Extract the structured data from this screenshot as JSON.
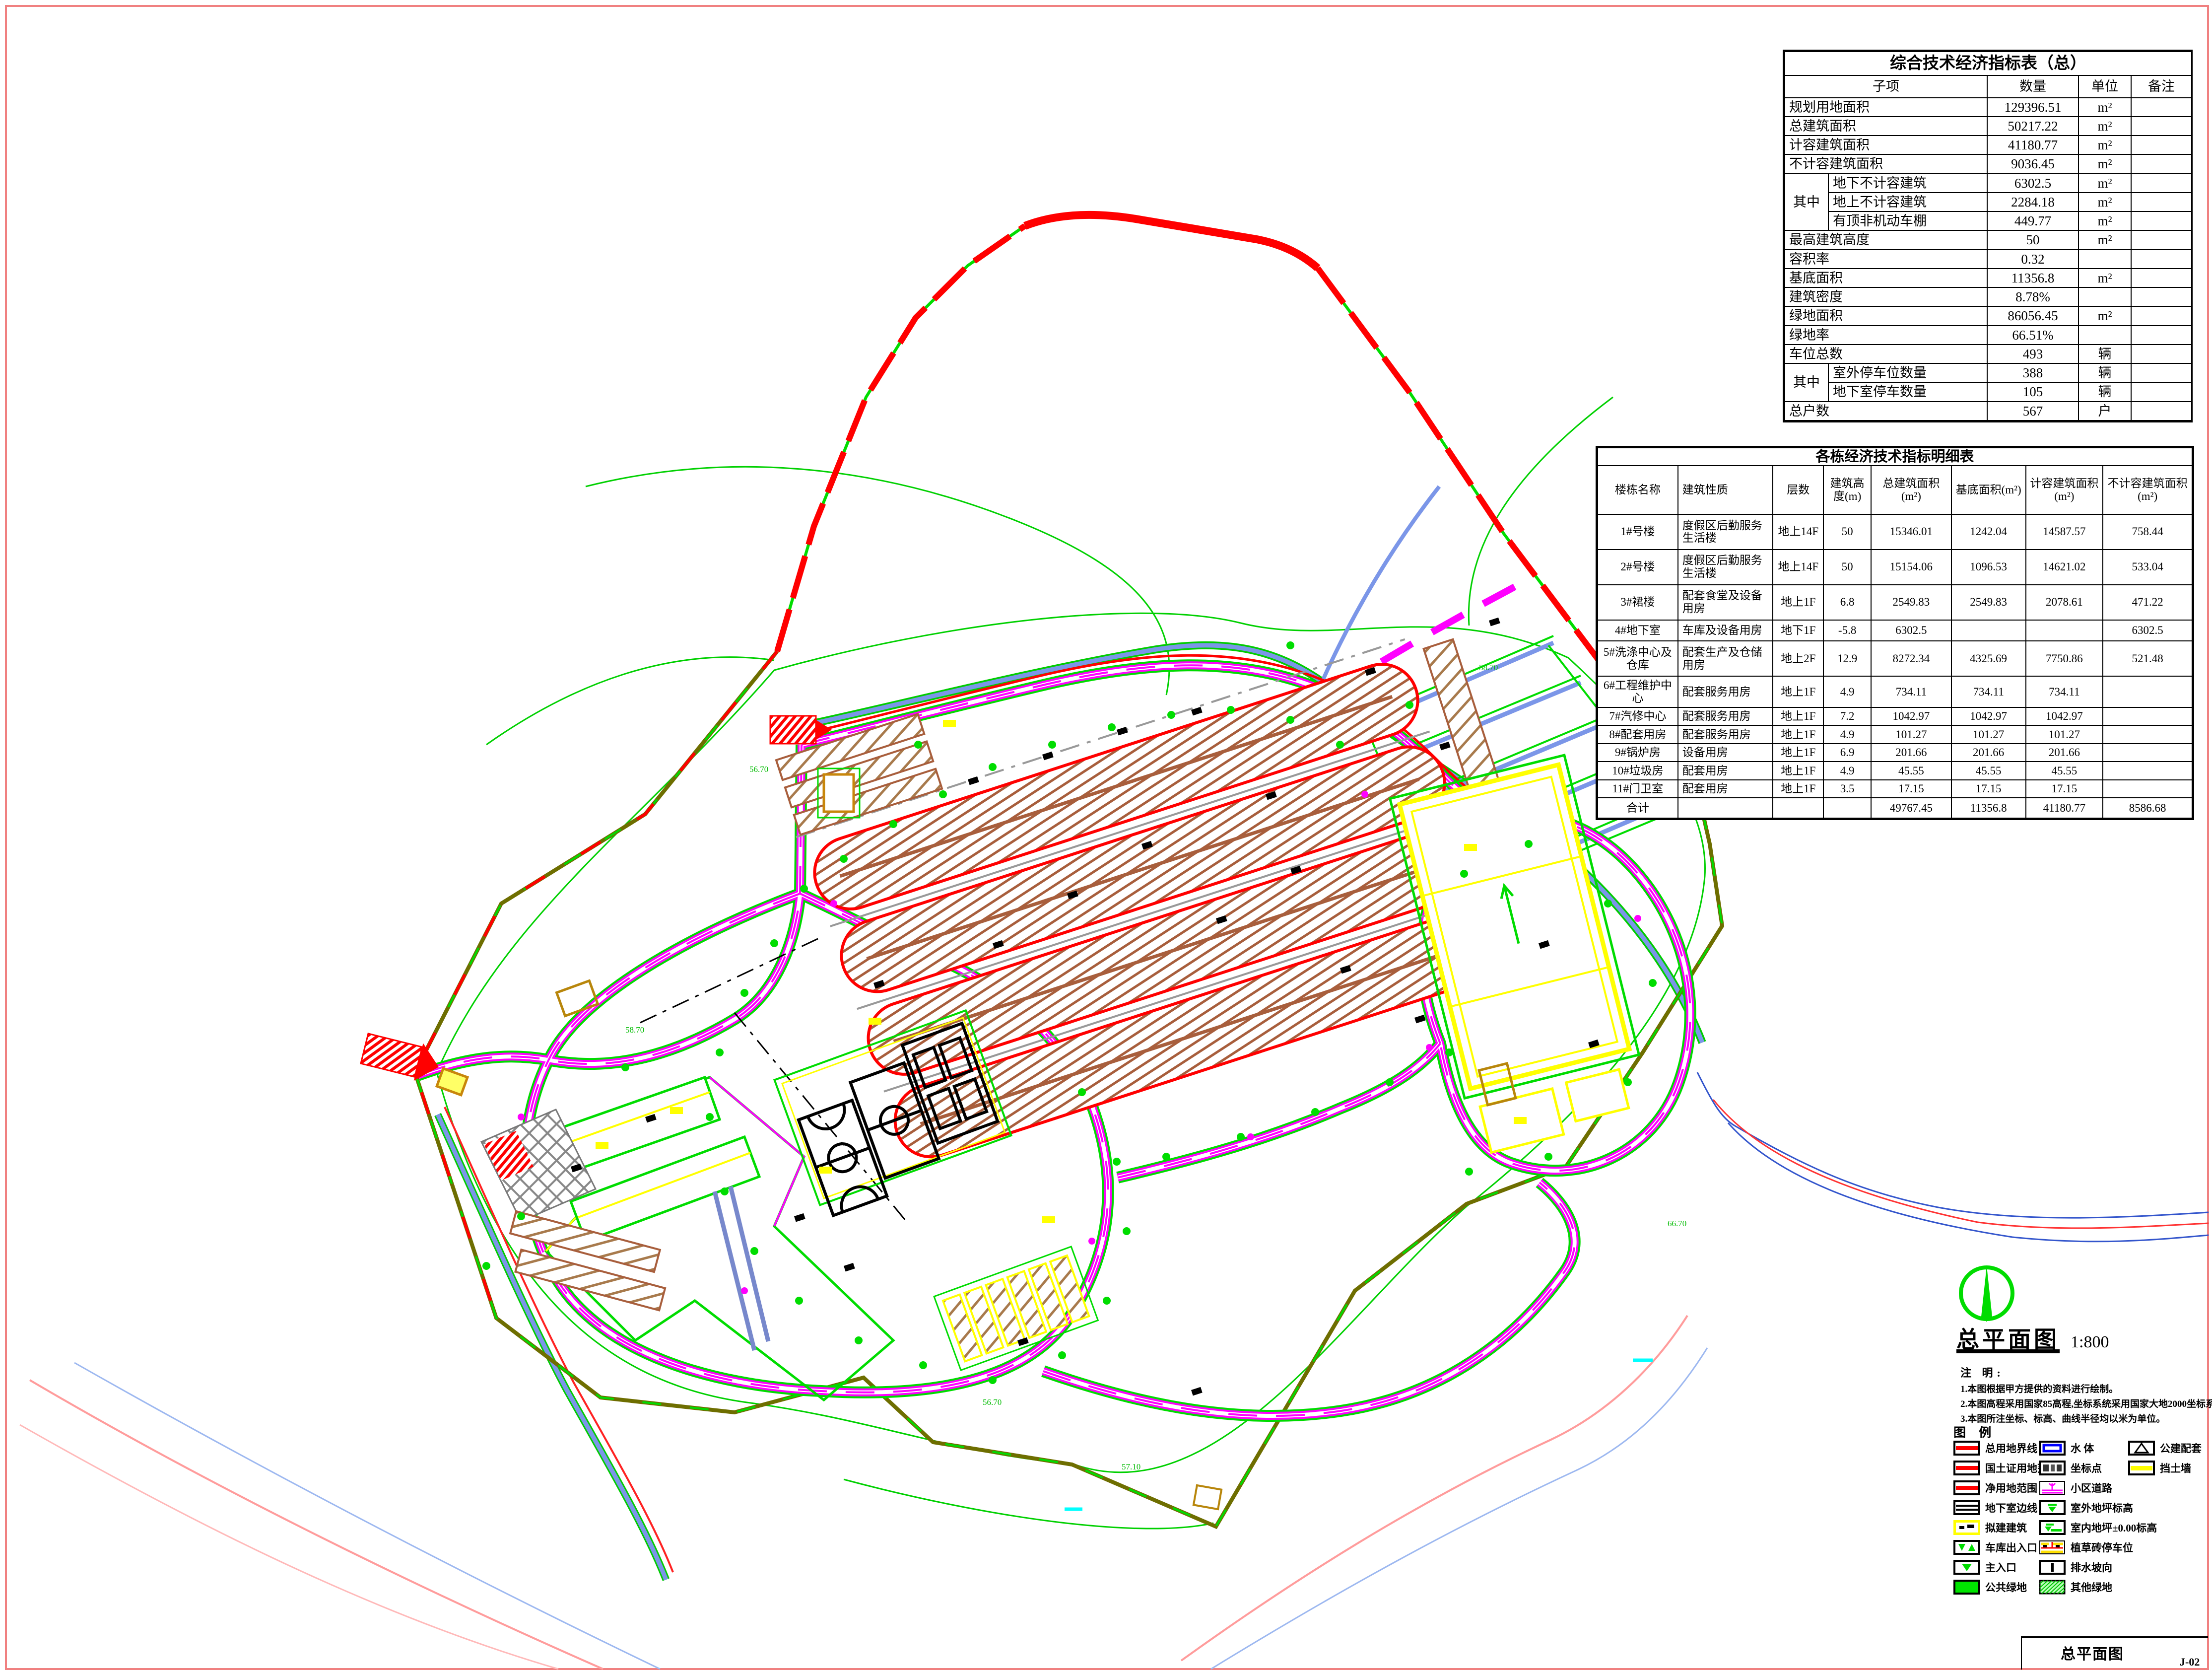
{
  "summary_table": {
    "title": "综合技术经济指标表（总）",
    "columns": [
      "子项",
      "数量",
      "单位",
      "备注"
    ],
    "rows": [
      [
        {
          "t": "规划用地面积",
          "cs": 2,
          "al": "l"
        },
        {
          "t": "129396.51"
        },
        {
          "t": "m²"
        },
        {
          "t": ""
        }
      ],
      [
        {
          "t": "总建筑面积",
          "cs": 2,
          "al": "l"
        },
        {
          "t": "50217.22"
        },
        {
          "t": "m²"
        },
        {
          "t": ""
        }
      ],
      [
        {
          "t": "计容建筑面积",
          "cs": 2,
          "al": "l"
        },
        {
          "t": "41180.77"
        },
        {
          "t": "m²"
        },
        {
          "t": ""
        }
      ],
      [
        {
          "t": "不计容建筑面积",
          "cs": 2,
          "al": "l"
        },
        {
          "t": "9036.45"
        },
        {
          "t": "m²"
        },
        {
          "t": ""
        }
      ],
      [
        {
          "t": "其中",
          "rs": 3
        },
        {
          "t": "地下不计容建筑",
          "al": "l"
        },
        {
          "t": "6302.5"
        },
        {
          "t": "m²"
        },
        {
          "t": ""
        }
      ],
      [
        {
          "t": "地上不计容建筑",
          "al": "l"
        },
        {
          "t": "2284.18"
        },
        {
          "t": "m²"
        },
        {
          "t": ""
        }
      ],
      [
        {
          "t": "有顶非机动车棚",
          "al": "l"
        },
        {
          "t": "449.77"
        },
        {
          "t": "m²"
        },
        {
          "t": ""
        }
      ],
      [
        {
          "t": "最高建筑高度",
          "cs": 2,
          "al": "l"
        },
        {
          "t": "50"
        },
        {
          "t": "m²"
        },
        {
          "t": ""
        }
      ],
      [
        {
          "t": "容积率",
          "cs": 2,
          "al": "l"
        },
        {
          "t": "0.32"
        },
        {
          "t": ""
        },
        {
          "t": ""
        }
      ],
      [
        {
          "t": "基底面积",
          "cs": 2,
          "al": "l"
        },
        {
          "t": "11356.8"
        },
        {
          "t": "m²"
        },
        {
          "t": ""
        }
      ],
      [
        {
          "t": "建筑密度",
          "cs": 2,
          "al": "l"
        },
        {
          "t": "8.78%"
        },
        {
          "t": ""
        },
        {
          "t": ""
        }
      ],
      [
        {
          "t": "绿地面积",
          "cs": 2,
          "al": "l"
        },
        {
          "t": "86056.45"
        },
        {
          "t": "m²"
        },
        {
          "t": ""
        }
      ],
      [
        {
          "t": "绿地率",
          "cs": 2,
          "al": "l"
        },
        {
          "t": "66.51%"
        },
        {
          "t": ""
        },
        {
          "t": ""
        }
      ],
      [
        {
          "t": "车位总数",
          "cs": 2,
          "al": "l"
        },
        {
          "t": "493"
        },
        {
          "t": "辆"
        },
        {
          "t": ""
        }
      ],
      [
        {
          "t": "其中",
          "rs": 2
        },
        {
          "t": "室外停车位数量",
          "al": "l"
        },
        {
          "t": "388"
        },
        {
          "t": "辆"
        },
        {
          "t": ""
        }
      ],
      [
        {
          "t": "地下室停车数量",
          "al": "l"
        },
        {
          "t": "105"
        },
        {
          "t": "辆"
        },
        {
          "t": ""
        }
      ],
      [
        {
          "t": "总户数",
          "cs": 2,
          "al": "l"
        },
        {
          "t": "567"
        },
        {
          "t": "户"
        },
        {
          "t": ""
        }
      ]
    ]
  },
  "detail_table": {
    "title": "各栋经济技术指标明细表",
    "columns": [
      "楼栋名称",
      "建筑性质",
      "层数",
      "建筑高度(m)",
      "总建筑面积(m²)",
      "基底面积(m²)",
      "计容建筑面积(m²)",
      "不计容建筑面积(m²)"
    ],
    "rows": [
      [
        "1#号楼",
        "度假区后勤服务生活楼",
        "地上14F",
        "50",
        "15346.01",
        "1242.04",
        "14587.57",
        "758.44"
      ],
      [
        "2#号楼",
        "度假区后勤服务生活楼",
        "地上14F",
        "50",
        "15154.06",
        "1096.53",
        "14621.02",
        "533.04"
      ],
      [
        "3#裙楼",
        "配套食堂及设备用房",
        "地上1F",
        "6.8",
        "2549.83",
        "2549.83",
        "2078.61",
        "471.22"
      ],
      [
        "4#地下室",
        "车库及设备用房",
        "地下1F",
        "-5.8",
        "6302.5",
        "",
        "",
        "6302.5"
      ],
      [
        "5#洗涤中心及仓库",
        "配套生产及仓储用房",
        "地上2F",
        "12.9",
        "8272.34",
        "4325.69",
        "7750.86",
        "521.48"
      ],
      [
        "6#工程维护中心",
        "配套服务用房",
        "地上1F",
        "4.9",
        "734.11",
        "734.11",
        "734.11",
        ""
      ],
      [
        "7#汽修中心",
        "配套服务用房",
        "地上1F",
        "7.2",
        "1042.97",
        "1042.97",
        "1042.97",
        ""
      ],
      [
        "8#配套用房",
        "配套服务用房",
        "地上1F",
        "4.9",
        "101.27",
        "101.27",
        "101.27",
        ""
      ],
      [
        "9#锅炉房",
        "设备用房",
        "地上1F",
        "6.9",
        "201.66",
        "201.66",
        "201.66",
        ""
      ],
      [
        "10#垃圾房",
        "配套用房",
        "地上1F",
        "4.9",
        "45.55",
        "45.55",
        "45.55",
        ""
      ],
      [
        "11#门卫室",
        "配套用房",
        "地上1F",
        "3.5",
        "17.15",
        "17.15",
        "17.15",
        ""
      ],
      [
        "合计",
        "",
        "",
        "",
        "49767.45",
        "11356.8",
        "41180.77",
        "8586.68"
      ]
    ]
  },
  "map_title": {
    "text": "总平面图",
    "scale": "1:800"
  },
  "notes": {
    "heading": "注  明:",
    "items": [
      "1.本图根据甲方提供的资料进行绘制。",
      "2.本图高程采用国家85高程,坐标系统采用国家大地2000坐标系统。",
      "3.本图所注坐标、标高、曲线半径均以米为单位。"
    ]
  },
  "legend": {
    "title": "图  例",
    "items": [
      {
        "col": 0,
        "swatch": "red-line",
        "label": "总用地界线"
      },
      {
        "col": 0,
        "swatch": "red-line",
        "label": "国土证用地范围"
      },
      {
        "col": 0,
        "swatch": "red-line",
        "label": "净用地范围"
      },
      {
        "col": 0,
        "swatch": "black-line",
        "label": "地下室边线"
      },
      {
        "col": 0,
        "swatch": "yellow-building",
        "label": "拟建建筑"
      },
      {
        "col": 0,
        "swatch": "garage-entrance",
        "label": "车库出入口"
      },
      {
        "col": 0,
        "swatch": "main-entrance",
        "label": "主入口"
      },
      {
        "col": 0,
        "swatch": "green-solid",
        "label": "公共绿地"
      },
      {
        "col": 1,
        "swatch": "water",
        "label": "水 体"
      },
      {
        "col": 1,
        "swatch": "coord-point",
        "label": "坐标点"
      },
      {
        "col": 1,
        "swatch": "road",
        "label": "小区道路"
      },
      {
        "col": 1,
        "swatch": "elev-outdoor",
        "label": "室外地坪标高"
      },
      {
        "col": 1,
        "swatch": "elev-indoor",
        "label": "室内地坪±0.00标高"
      },
      {
        "col": 1,
        "swatch": "grass-parking",
        "label": "植草砖停车位"
      },
      {
        "col": 1,
        "swatch": "drain",
        "label": "排水坡向"
      },
      {
        "col": 1,
        "swatch": "other-green",
        "label": "其他绿地"
      },
      {
        "col": 2,
        "swatch": "slope",
        "label": "公建配套"
      },
      {
        "col": 2,
        "swatch": "retaining-wall",
        "label": "挡土墙"
      }
    ]
  },
  "titleblock": {
    "name": "总平面图",
    "number": "J-02"
  },
  "elevation_labels": [
    "56.70",
    "58.70",
    "57.10",
    "66.70"
  ],
  "colors": {
    "frame_pink": "#f08080",
    "boundary_red": "#ff0000",
    "landscape_green": "#00dc00",
    "road_magenta": "#ff00ff",
    "building_yellow": "#ffff00",
    "site_olive": "#6e6e00",
    "parking_brown": "#a85e3c",
    "stream_blue": "#7b96e8",
    "plaza_gray": "#888888",
    "shed_goldenrod": "#c8860b",
    "cyan_mark": "#00ffff"
  }
}
